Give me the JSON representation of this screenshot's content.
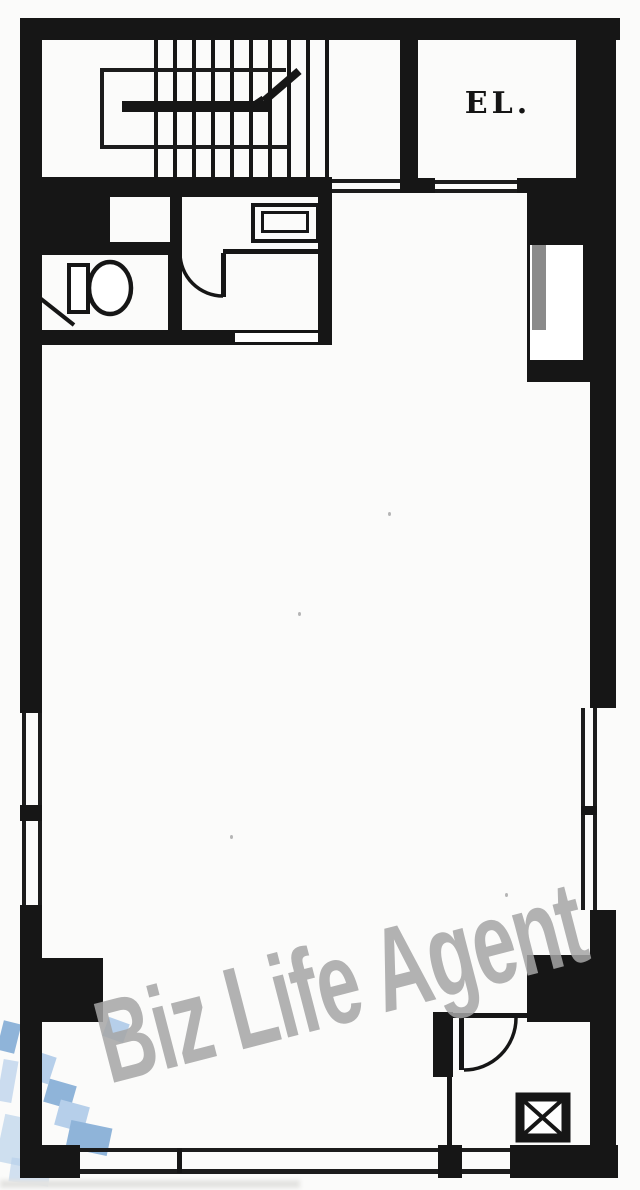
{
  "plan": {
    "title": "Building floor plan",
    "elevator_label": "EL.",
    "watermark_text": "Biz Life Agent",
    "colors": {
      "wall": "#161616",
      "line": "#1c1c1c",
      "watermark": "#a6a6a6",
      "logo_light": "#b6cfea",
      "logo_mid": "#8fb4d9",
      "paper": "#fbfbfa"
    },
    "fixtures": {
      "staircase": "staircase-with-up-arrow",
      "elevator": "elevator-shaft",
      "toilet": "toilet-bowl-and-tank",
      "sink": "sink-counter",
      "duct": "x-crossed-shaft-box",
      "doors": "quarter-circle-door-swings",
      "windows": "double-line-window-bands"
    }
  }
}
